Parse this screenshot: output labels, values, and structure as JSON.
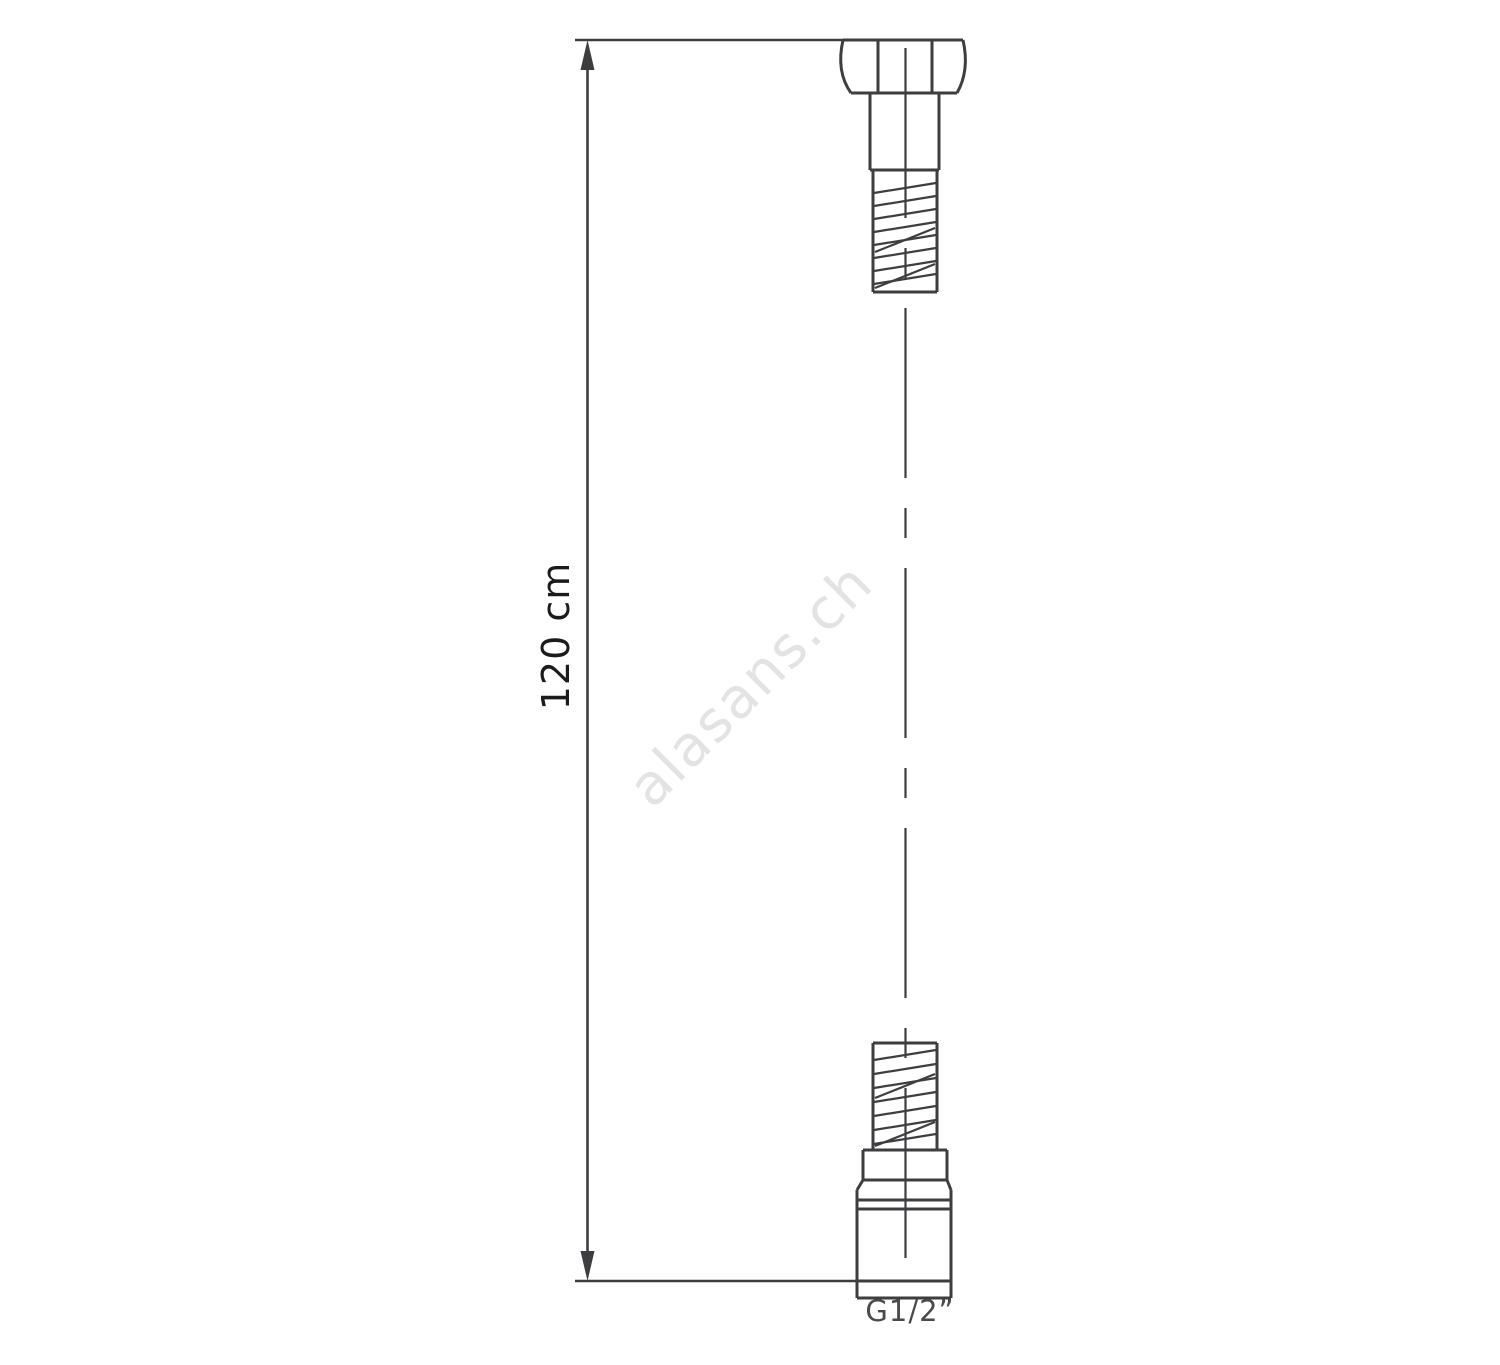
{
  "diagram": {
    "type": "technical-drawing",
    "subject": "shower-hose",
    "dimension_label": "120 cm",
    "thread_label": "G1/2”",
    "watermark": "alasans.ch"
  },
  "colors": {
    "background": "#ffffff",
    "line": "#3e3e41",
    "dimension_text": "#1b1b1d",
    "thread_text": "#4a4a4b",
    "watermark": "#e3e3e3"
  }
}
